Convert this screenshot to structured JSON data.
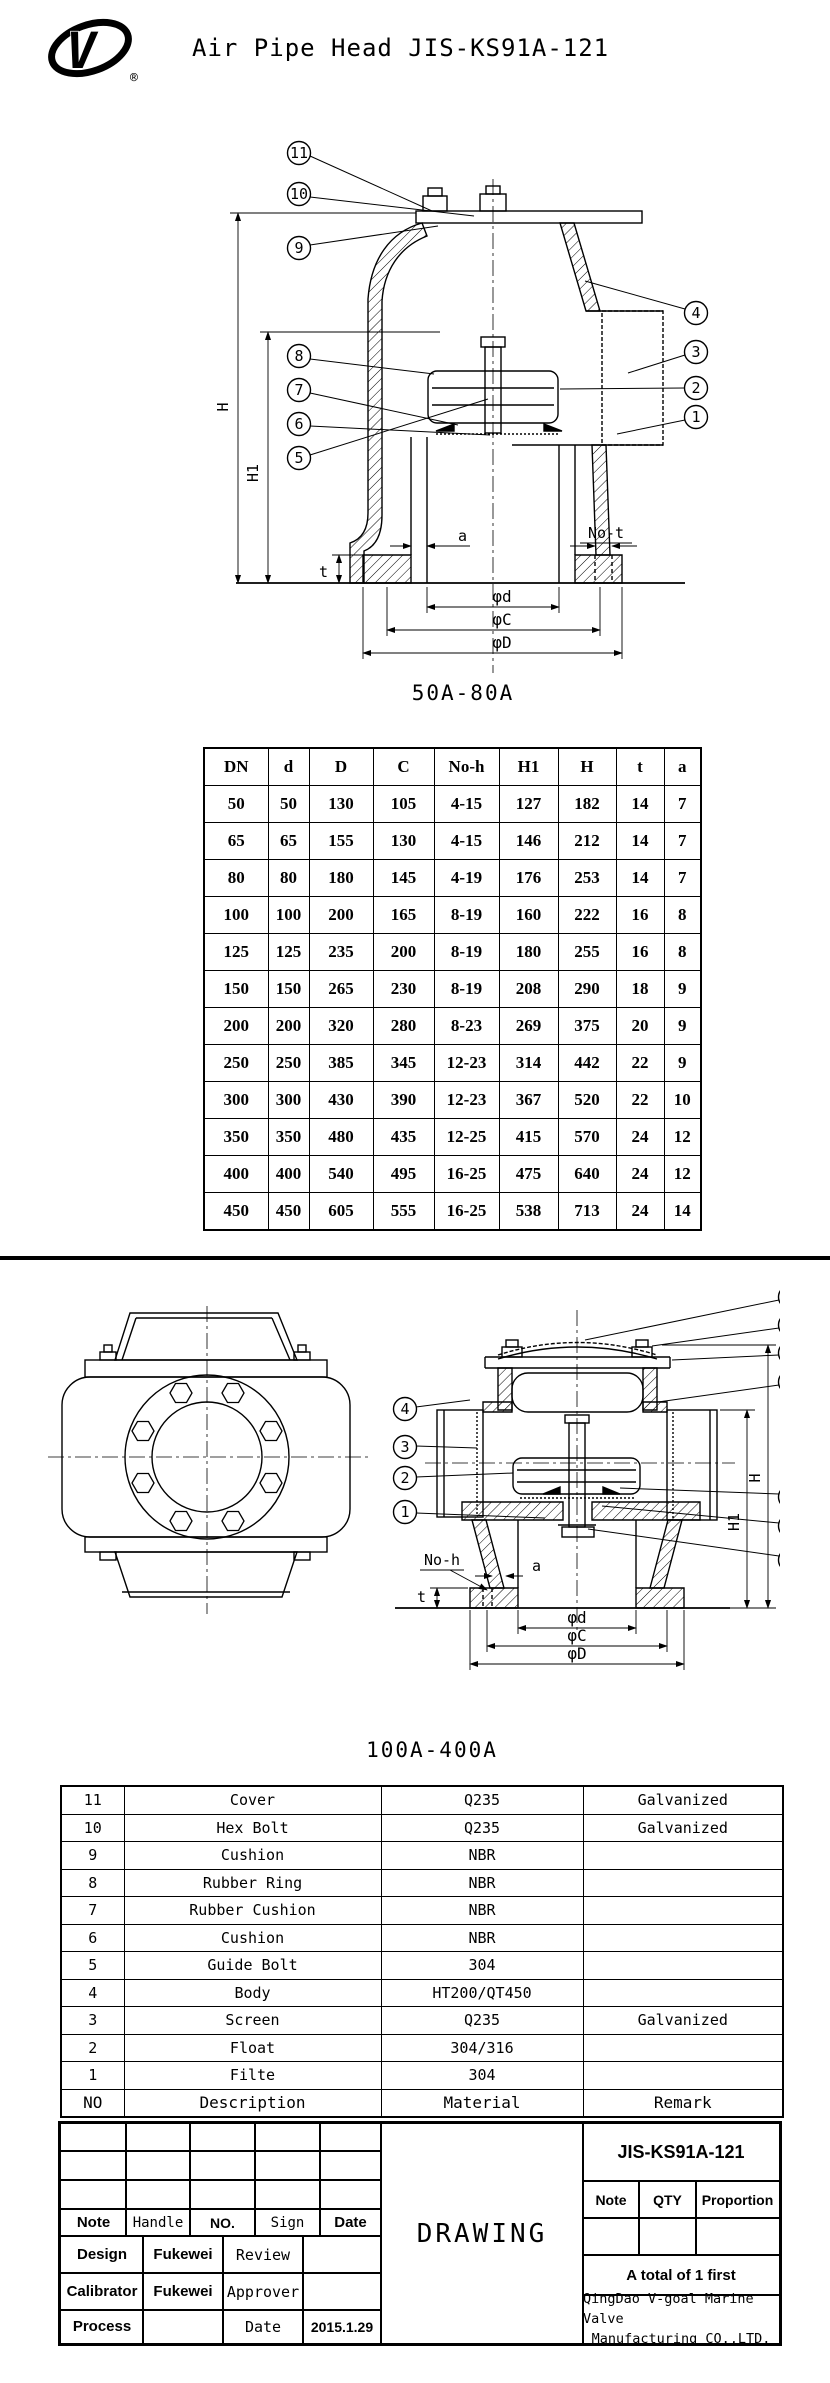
{
  "header": {
    "title": "Air Pipe Head JIS-KS91A-121",
    "registered_mark": "®",
    "logo": "v-goal-logo"
  },
  "labels": {
    "n1": "1",
    "n2": "2",
    "n3": "3",
    "n4": "4",
    "n5": "5",
    "n6": "6",
    "n7": "7",
    "n8": "8",
    "n9": "9",
    "n10": "10",
    "n11": "11",
    "H": "H",
    "H1": "H1",
    "a": "a",
    "t": "t",
    "no_t": "No-t",
    "no_h": "No-h",
    "phi_d": "φd",
    "phi_c": "φC",
    "phi_D": "φD"
  },
  "drawing1": {
    "caption": "50A-80A"
  },
  "drawing2": {
    "caption": "100A-400A"
  },
  "dim_table": {
    "headers": [
      "DN",
      "d",
      "D",
      "C",
      "No-h",
      "H1",
      "H",
      "t",
      "a"
    ],
    "rows": [
      [
        "50",
        "50",
        "130",
        "105",
        "4-15",
        "127",
        "182",
        "14",
        "7"
      ],
      [
        "65",
        "65",
        "155",
        "130",
        "4-15",
        "146",
        "212",
        "14",
        "7"
      ],
      [
        "80",
        "80",
        "180",
        "145",
        "4-19",
        "176",
        "253",
        "14",
        "7"
      ],
      [
        "100",
        "100",
        "200",
        "165",
        "8-19",
        "160",
        "222",
        "16",
        "8"
      ],
      [
        "125",
        "125",
        "235",
        "200",
        "8-19",
        "180",
        "255",
        "16",
        "8"
      ],
      [
        "150",
        "150",
        "265",
        "230",
        "8-19",
        "208",
        "290",
        "18",
        "9"
      ],
      [
        "200",
        "200",
        "320",
        "280",
        "8-23",
        "269",
        "375",
        "20",
        "9"
      ],
      [
        "250",
        "250",
        "385",
        "345",
        "12-23",
        "314",
        "442",
        "22",
        "9"
      ],
      [
        "300",
        "300",
        "430",
        "390",
        "12-23",
        "367",
        "520",
        "22",
        "10"
      ],
      [
        "350",
        "350",
        "480",
        "435",
        "12-25",
        "415",
        "570",
        "24",
        "12"
      ],
      [
        "400",
        "400",
        "540",
        "495",
        "16-25",
        "475",
        "640",
        "24",
        "12"
      ],
      [
        "450",
        "450",
        "605",
        "555",
        "16-25",
        "538",
        "713",
        "24",
        "14"
      ]
    ]
  },
  "parts_table": {
    "rows": [
      [
        "11",
        "Cover",
        "Q235",
        "Galvanized"
      ],
      [
        "10",
        "Hex Bolt",
        "Q235",
        "Galvanized"
      ],
      [
        "9",
        "Cushion",
        "NBR",
        ""
      ],
      [
        "8",
        "Rubber Ring",
        "NBR",
        ""
      ],
      [
        "7",
        "Rubber Cushion",
        "NBR",
        ""
      ],
      [
        "6",
        "Cushion",
        "NBR",
        ""
      ],
      [
        "5",
        "Guide Bolt",
        "304",
        ""
      ],
      [
        "4",
        "Body",
        "HT200/QT450",
        ""
      ],
      [
        "3",
        "Screen",
        "Q235",
        "Galvanized"
      ],
      [
        "2",
        "Float",
        "304/316",
        ""
      ],
      [
        "1",
        "Filte",
        "304",
        ""
      ]
    ],
    "footer": [
      "NO",
      "Description",
      "Material",
      "Remark"
    ]
  },
  "title_block": {
    "col_headers": [
      "Note",
      "Handle",
      "NO.",
      "Sign",
      "Date"
    ],
    "design_label": "Design",
    "design_value": "Fukewei",
    "review_label": "Review",
    "review_value": "",
    "calibrator_label": "Calibrator",
    "calibrator_value": "Fukewei",
    "approver_label": "Approver",
    "approver_value": "",
    "process_label": "Process",
    "process_value": "",
    "date_label": "Date",
    "date_value": "2015.1.29",
    "drawing_label": "DRAWING",
    "model": "JIS-KS91A-121",
    "qty_headers": [
      "Note",
      "QTY",
      "Proportion"
    ],
    "total_note": "A total of 1 first",
    "company_line1": "QingDao V-goal Marine Valve",
    "company_line2": "Manufacturing CO.,LTD."
  }
}
